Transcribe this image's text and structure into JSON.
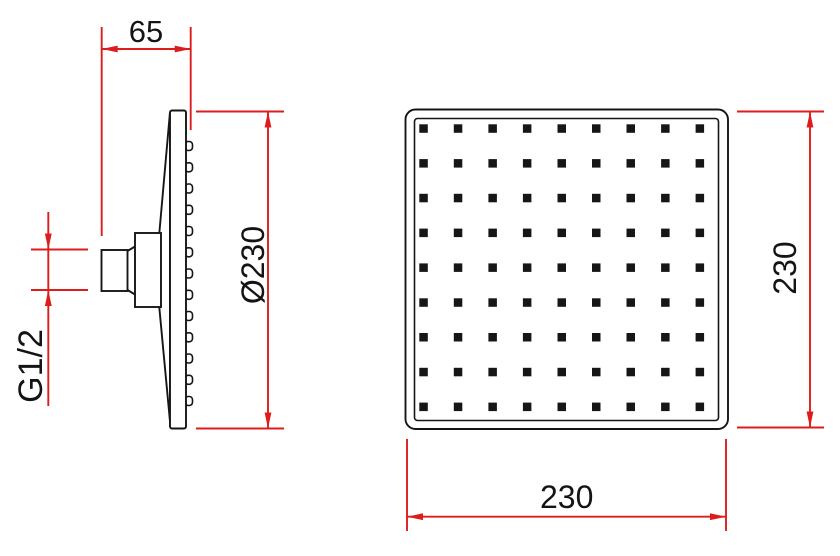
{
  "dimensions": {
    "side_depth": "65",
    "side_diameter": "Ø230",
    "thread_size": "G1/2",
    "front_height": "230",
    "front_width": "230"
  },
  "front_view": {
    "nozzle_rows": 9,
    "nozzle_cols": 9
  },
  "side_view": {
    "nozzle_bumps": 13
  },
  "colors": {
    "dimension_lines": "#de1c1c",
    "outline": "#161616"
  }
}
